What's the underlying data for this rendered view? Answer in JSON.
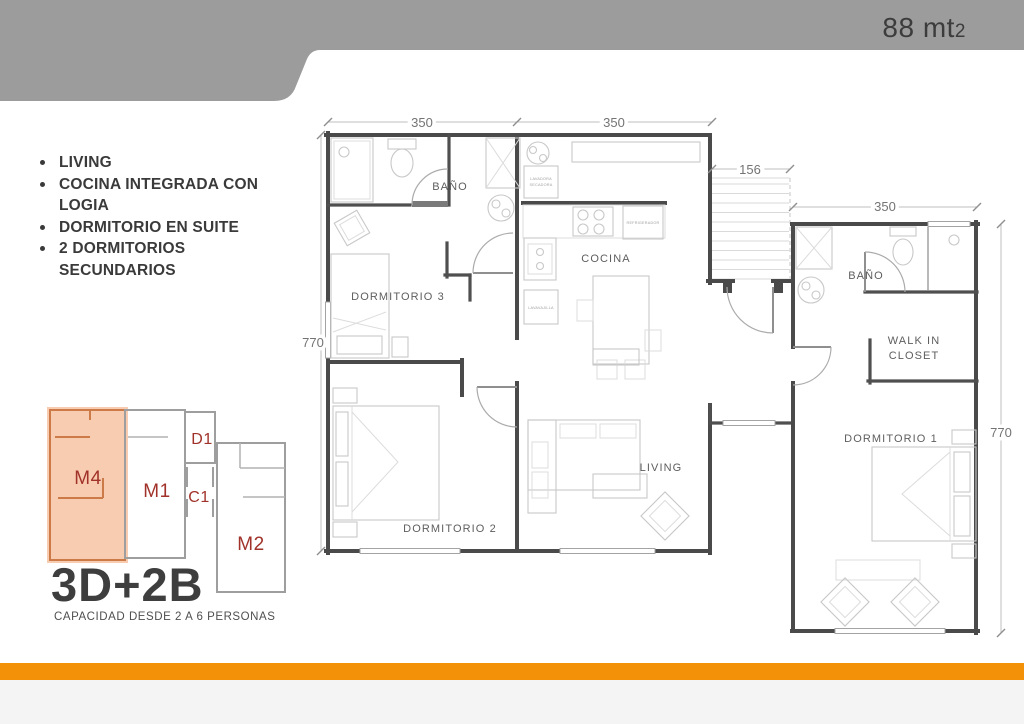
{
  "header": {
    "area": "88 mt",
    "area_sup": "2"
  },
  "features": {
    "items": [
      "LIVING",
      "COCINA INTEGRADA CON LOGIA",
      "DORMITORIO  EN SUITE",
      "2 DORMITORIOS SECUNDARIOS"
    ]
  },
  "plan": {
    "rooms": {
      "bano_main": "BAÑO",
      "dorm3": "DORMITORIO 3",
      "cocina": "COCINA",
      "dorm2": "DORMITORIO 2",
      "living": "LIVING",
      "bano_suite": "BAÑO",
      "walkin1": "WALK IN",
      "walkin2": "CLOSET",
      "dorm1": "DORMITORIO 1"
    },
    "appliances": {
      "washer_line1": "LAVADORA",
      "washer_line2": "SECADORA",
      "fridge": "REFRIGERADOR",
      "dishwasher": "LAVAVAJILLA"
    },
    "dimensions": {
      "top_left": "350",
      "top_right": "350",
      "entry": "156",
      "wing_top": "350",
      "left_height": "770",
      "wing_height": "770"
    }
  },
  "key_plan": {
    "title": "3D+2B",
    "capacity": "CAPACIDAD DESDE 2 A  6 PERSONAS",
    "units": {
      "m4": "M4",
      "m1": "M1",
      "d1": "D1",
      "c1": "C1",
      "m2": "M2"
    },
    "highlighted_unit": "M4"
  },
  "colors": {
    "banner_gray": "#9C9C9C",
    "accent_orange": "#F39208",
    "highlight_fill": "#F0945A",
    "unit_label_red": "#A1322A",
    "footer_strip": "#F4F4F4"
  }
}
